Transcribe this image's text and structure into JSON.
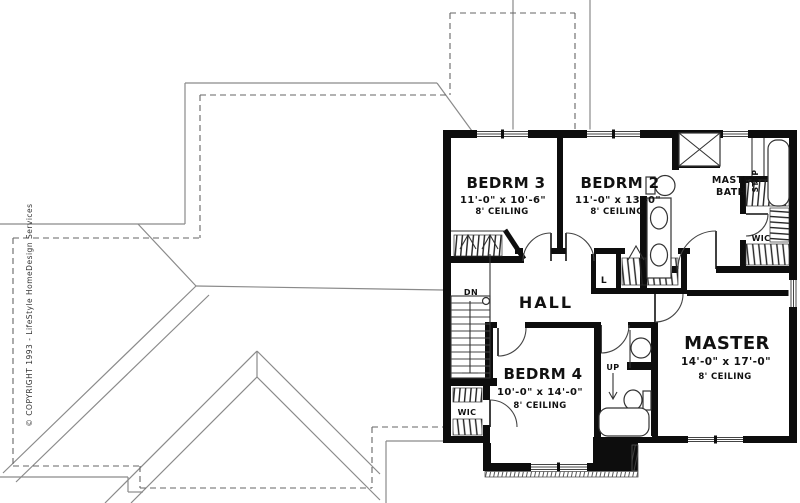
{
  "drawing_title": "Second floor plan",
  "copyright": "© COPYRIGHT 1993 - LifeStyle HomeDesign Services",
  "rooms": {
    "bedrm3": {
      "name": "BEDRM 3",
      "dims": "11'-0\" x 10'-6\"",
      "ceiling": "8' CEILING"
    },
    "bedrm2": {
      "name": "BEDRM 2",
      "dims": "11'-0\" x 13'-0\"",
      "ceiling": "8' CEILING"
    },
    "bedrm4": {
      "name": "BEDRM 4",
      "dims": "10'-0\" x 14'-0\"",
      "ceiling": "8' CEILING"
    },
    "master": {
      "name": "MASTER",
      "dims": "14'-0\" x 17'-0\"",
      "ceiling": "8' CEILING"
    },
    "master_bath": {
      "line1": "MASTER",
      "line2": "BATH"
    },
    "hall": {
      "name": "HALL"
    }
  },
  "labels": {
    "wic_master": "WIC",
    "wic_bedrm4": "WIC",
    "linen_closet": "L",
    "stairs_down": "DN",
    "stairs_up": "UP",
    "tub_step": "STEP"
  },
  "colors": {
    "walls": "#0d0d0d",
    "roof_lines": "#8a8a8a",
    "dashed_footprint": "#666666",
    "background": "#ffffff"
  }
}
